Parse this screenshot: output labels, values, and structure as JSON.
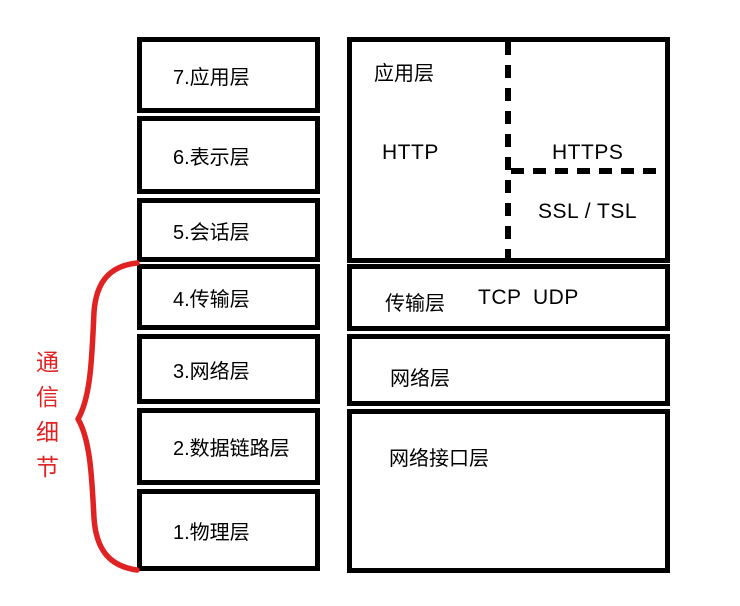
{
  "colors": {
    "ink": "#000000",
    "accent": "#e02222",
    "bg": "#ffffff"
  },
  "osi": {
    "name": "OSI seven layer model column",
    "layers": [
      {
        "label": "7.应用层"
      },
      {
        "label": "6.表示层"
      },
      {
        "label": "5.会话层"
      },
      {
        "label": "4.传输层"
      },
      {
        "label": "3.网络层"
      },
      {
        "label": "2.数据链路层"
      },
      {
        "label": "1.物理层"
      }
    ]
  },
  "tcpip": {
    "name": "TCP/IP model column",
    "application": {
      "label": "应用层",
      "http": "HTTP",
      "https": "HTTPS",
      "ssl": "SSL / TSL"
    },
    "transport": {
      "label": "传输层",
      "tcp": "TCP",
      "udp": "UDP"
    },
    "network": {
      "label": "网络层"
    },
    "interface": {
      "label": "网络接口层"
    }
  },
  "annotation": {
    "label": "通信细节",
    "chars": [
      "通",
      "信",
      "细",
      "节"
    ]
  }
}
